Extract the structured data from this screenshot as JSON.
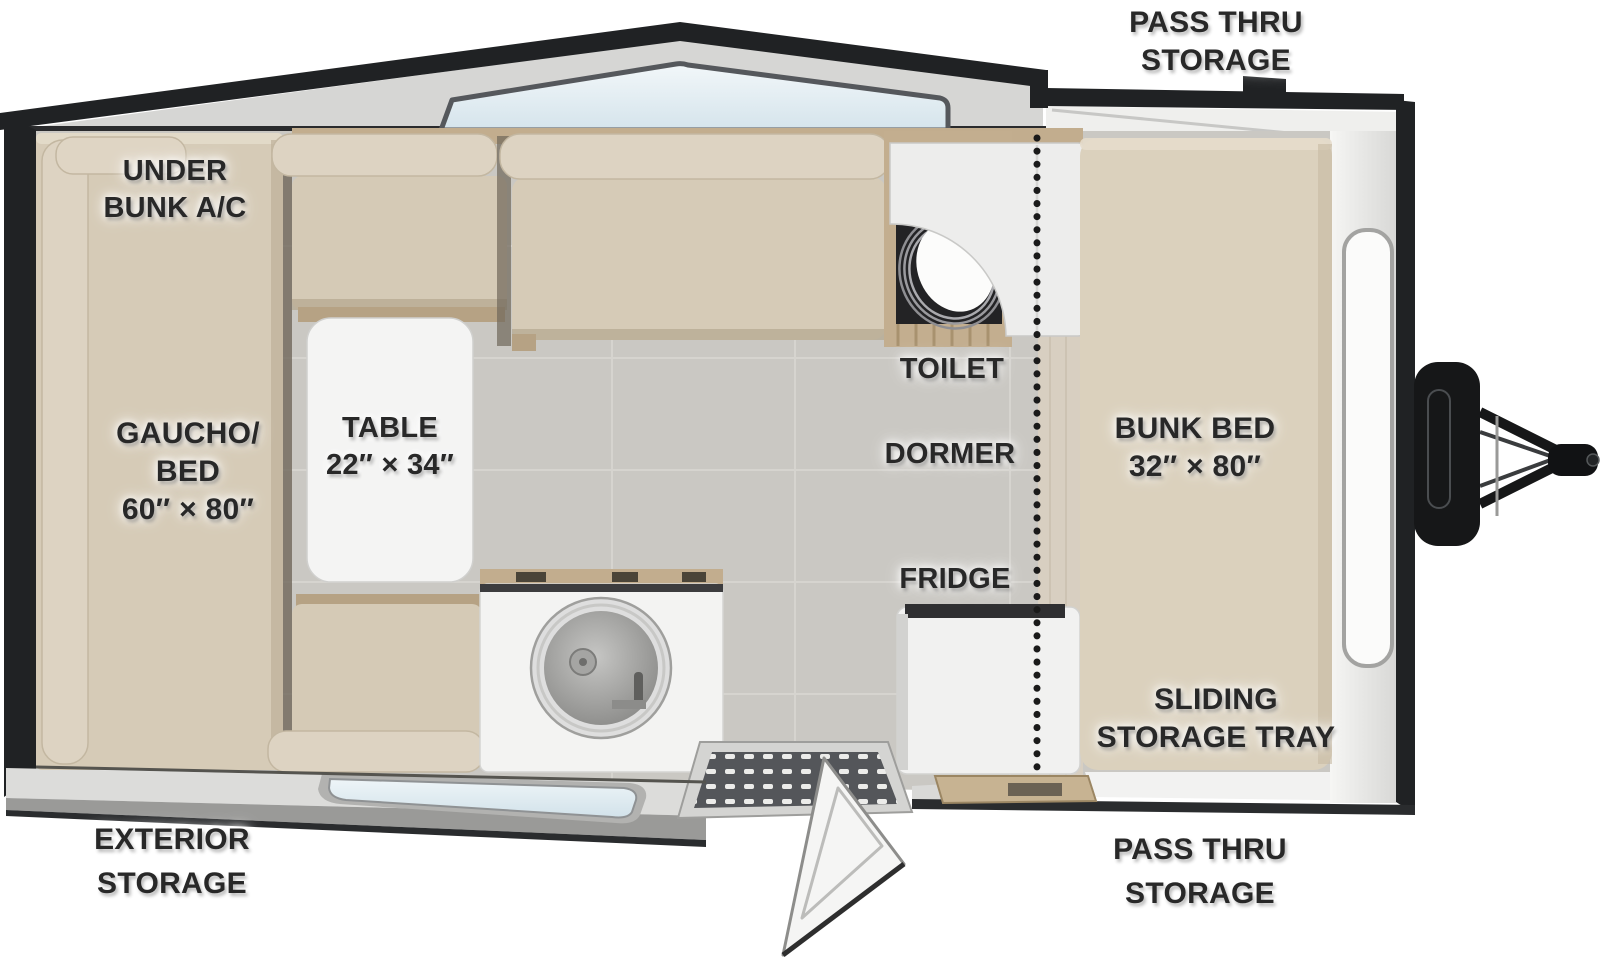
{
  "title": "A-frame camper floor plan",
  "colors": {
    "wall_dark": "#202224",
    "roof_gray": "#d6d6d4",
    "glass_blue": "#dce9f0",
    "cushion": "#d6cbb7",
    "cushion_light": "#ddd3c2",
    "wood": "#c2ad8e",
    "floor_tile": "#cac8c3",
    "fixture_white": "#f3f3f2",
    "label_text": "#282828"
  },
  "labels": {
    "pass_thru_storage_top": [
      "PASS THRU",
      "STORAGE"
    ],
    "under_bunk_ac": [
      "UNDER",
      "BUNK A/C"
    ],
    "gaucho_bed": [
      "GAUCHO/",
      "BED",
      "60″ × 80″"
    ],
    "table": [
      "TABLE",
      "22″ × 34″"
    ],
    "toilet": "TOILET",
    "dormer": "DORMER",
    "fridge": "FRIDGE",
    "bunk_bed": [
      "BUNK BED",
      "32″ × 80″"
    ],
    "sliding_storage_tray": [
      "SLIDING",
      "STORAGE TRAY"
    ],
    "exterior_storage": [
      "EXTERIOR",
      "STORAGE"
    ],
    "pass_thru_storage_bottom": [
      "PASS THRU",
      "STORAGE"
    ]
  }
}
